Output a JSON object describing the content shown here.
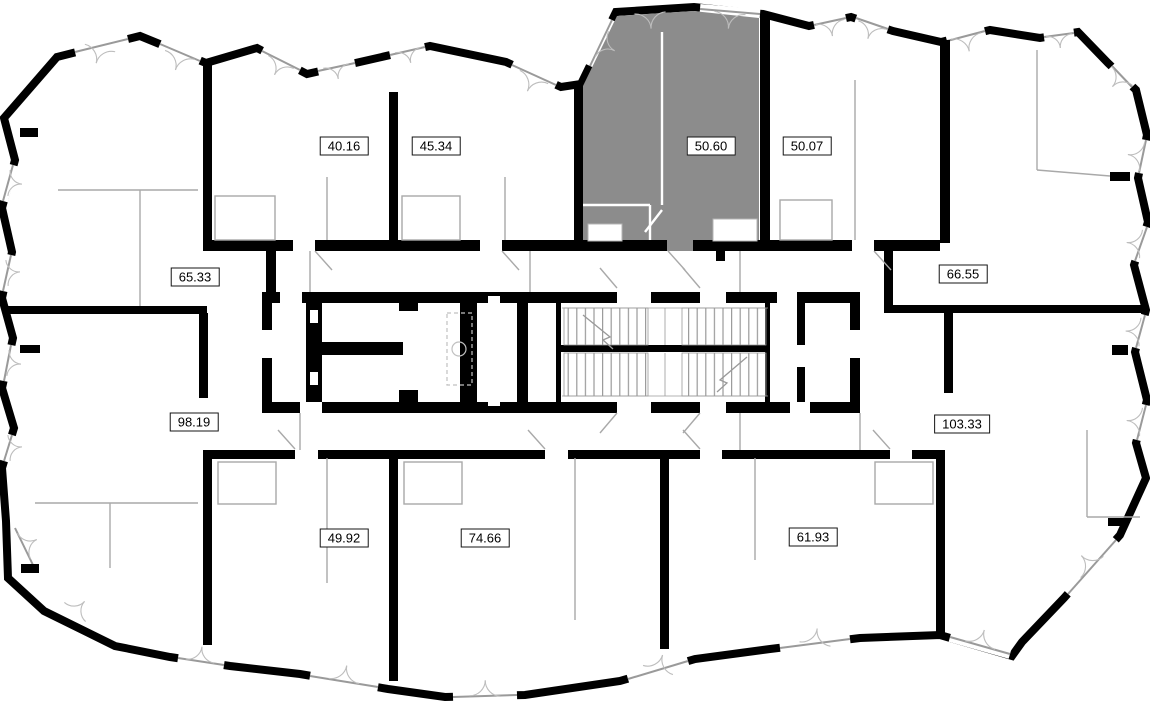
{
  "floor_plan": {
    "type": "residential-storey-plan",
    "colors": {
      "highlight": "#8c8c8c",
      "wall": "#000000",
      "partition": "#a9a9a9",
      "door_arc": "#bdbdbd",
      "background": "#ffffff"
    },
    "units": [
      {
        "area_label": "40.16",
        "highlighted": false
      },
      {
        "area_label": "45.34",
        "highlighted": false
      },
      {
        "area_label": "50.60",
        "highlighted": true
      },
      {
        "area_label": "50.07",
        "highlighted": false
      },
      {
        "area_label": "65.33",
        "highlighted": false
      },
      {
        "area_label": "66.55",
        "highlighted": false
      },
      {
        "area_label": "98.19",
        "highlighted": false
      },
      {
        "area_label": "103.33",
        "highlighted": false
      },
      {
        "area_label": "49.92",
        "highlighted": false
      },
      {
        "area_label": "74.66",
        "highlighted": false
      },
      {
        "area_label": "61.93",
        "highlighted": false
      }
    ]
  }
}
